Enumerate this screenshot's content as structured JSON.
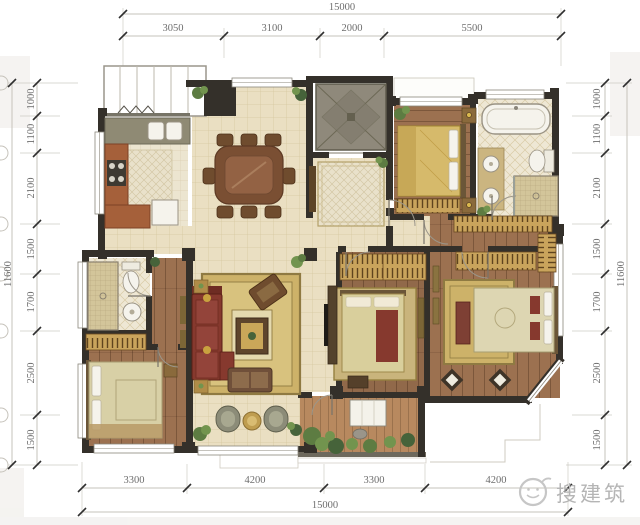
{
  "dims": {
    "top": {
      "total": "15000",
      "segments": [
        "3050",
        "3100",
        "2000",
        "5500"
      ]
    },
    "bottom": {
      "total": "15000",
      "segments": [
        "3300",
        "4200",
        "3300",
        "4200"
      ]
    },
    "left": {
      "total": "11600",
      "segments": [
        "1000",
        "1100",
        "2100",
        "1500",
        "1700",
        "2500",
        "1500"
      ]
    },
    "right": {
      "total": "11600",
      "segments": [
        "1000",
        "1100",
        "2100",
        "1500",
        "1700",
        "2500",
        "1500"
      ]
    }
  },
  "watermark": {
    "text": "搜建筑",
    "logo": "face-logo-icon"
  },
  "colors": {
    "wall": "#34302a",
    "dimline": "#c6c3bb",
    "tick": "#2f2f2f",
    "dimtext": "#6e6e6e",
    "tile": "#eadfc2",
    "tileLine": "#d5c7a0",
    "tileK": "#ece5d0",
    "tileKLine": "#dccfb2",
    "wood": "#9c7150",
    "deck": "#b8895f",
    "bathTile": "#eee7d4",
    "bathLine": "#d8cba6",
    "mosaic": "#d3c59a",
    "mosaicLine": "#b3a478",
    "hatch": "#c9a45c",
    "hatchTick": "#5f441e",
    "rug": "#cdb269",
    "rugBorder": "#8f7a42",
    "red": "#86392e",
    "elev": "#8f897b",
    "fixture": "#f5f3ec",
    "fixtureLine": "#9a9384",
    "gold": "#c9a23f",
    "headboard": "#6b5638",
    "furn": "#6f4c2e",
    "bedgold": "#d6ba6b",
    "bedpale": "#ddd6b2",
    "green1": "#5d7c42",
    "green2": "#72944e",
    "green3": "#46633a",
    "watermark": "#b5b5b5"
  }
}
